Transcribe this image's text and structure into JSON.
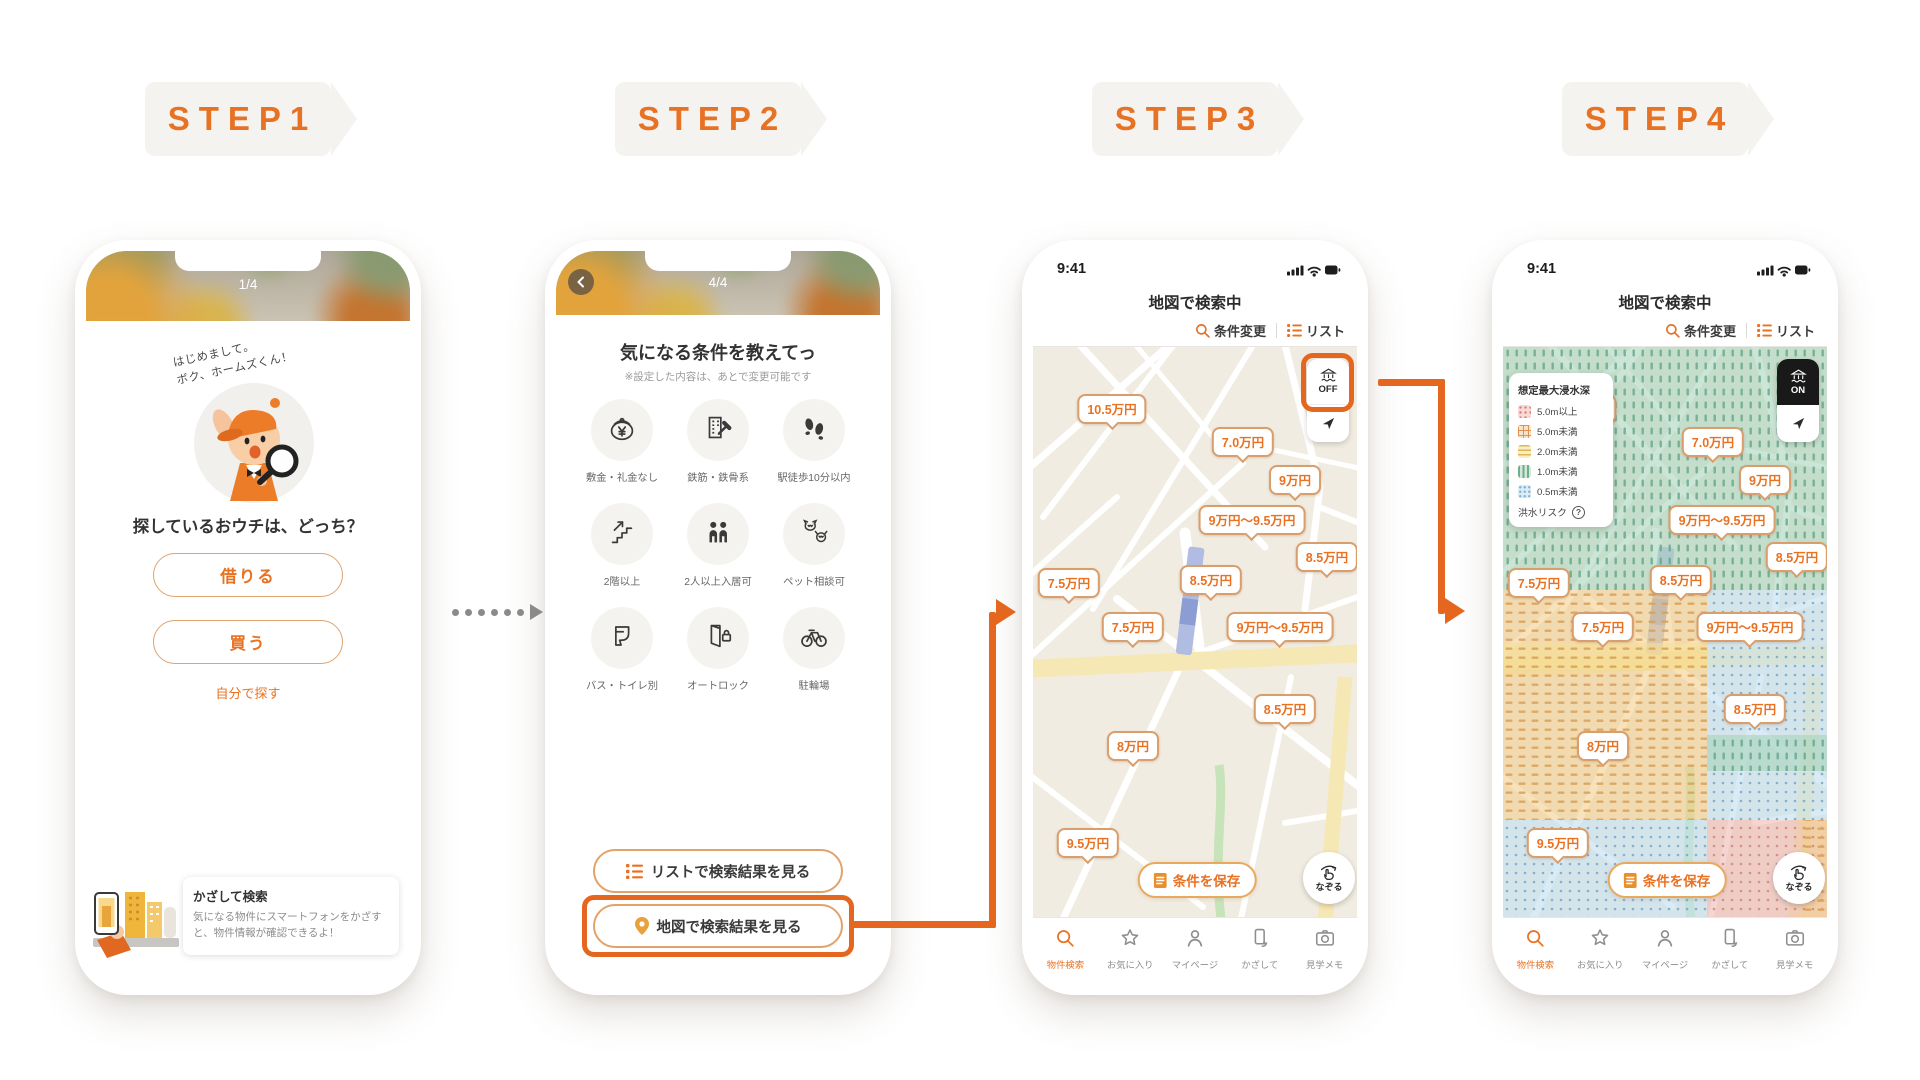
{
  "steps": [
    "STEP1",
    "STEP2",
    "STEP3",
    "STEP4"
  ],
  "colors": {
    "accent": "#E87122",
    "arrow": "#E5671F",
    "pin_border": "#D99E6B",
    "badge_bg": "#F5F3F0",
    "map_bg": "#F1ECE1"
  },
  "phone1": {
    "pager": "1/4",
    "speech_line1": "はじめまして。",
    "speech_line2": "ボク、ホームズくん！",
    "question": "探しているおウチは、どっち？",
    "rent_label": "借りる",
    "buy_label": "買う",
    "self_label": "自分で探す",
    "banner_title": "かざして検索",
    "banner_desc": "気になる物件にスマートフォンをかざすと、物件情報が確認できるよ！"
  },
  "phone2": {
    "pager": "4/4",
    "title": "気になる条件を教えてっ",
    "note": "※設定した内容は、あとで変更可能です",
    "conditions": [
      {
        "label": "敷金・礼金なし",
        "icon": "purse"
      },
      {
        "label": "鉄筋・鉄骨系",
        "icon": "building"
      },
      {
        "label": "駅徒歩10分以内",
        "icon": "footsteps"
      },
      {
        "label": "2階以上",
        "icon": "stairs"
      },
      {
        "label": "2人以上入居可",
        "icon": "people"
      },
      {
        "label": "ペット相談可",
        "icon": "pets"
      },
      {
        "label": "バス・トイレ別",
        "icon": "toilet"
      },
      {
        "label": "オートロック",
        "icon": "autolock"
      },
      {
        "label": "駐輪場",
        "icon": "bicycle"
      }
    ],
    "list_button_label": "リストで検索結果を見る",
    "map_button_label": "地図で検索結果を見る"
  },
  "map": {
    "status_time": "9:41",
    "title": "地図で検索中",
    "change_conditions_label": "条件変更",
    "list_label": "リスト",
    "toggle_off_label": "OFF",
    "toggle_on_label": "ON",
    "save_button_label": "条件を保存",
    "trace_button_label": "なぞる",
    "pins": [
      {
        "label": "10.5万円",
        "x": 79,
        "y": 62
      },
      {
        "label": "7.0万円",
        "x": 210,
        "y": 95
      },
      {
        "label": "9万円",
        "x": 262,
        "y": 133
      },
      {
        "label": "9万円〜9.5万円",
        "x": 219,
        "y": 173
      },
      {
        "label": "8.5万円",
        "x": 294,
        "y": 210
      },
      {
        "label": "7.5万円",
        "x": 36,
        "y": 236
      },
      {
        "label": "8.5万円",
        "x": 178,
        "y": 233
      },
      {
        "label": "7.5万円",
        "x": 100,
        "y": 280
      },
      {
        "label": "9万円〜9.5万円",
        "x": 247,
        "y": 280
      },
      {
        "label": "8.5万円",
        "x": 252,
        "y": 362
      },
      {
        "label": "8万円",
        "x": 100,
        "y": 399
      },
      {
        "label": "9.5万円",
        "x": 55,
        "y": 496
      }
    ],
    "tabs": [
      {
        "label": "物件検索",
        "icon": "search",
        "active": true
      },
      {
        "label": "お気に入り",
        "icon": "star",
        "active": false
      },
      {
        "label": "マイページ",
        "icon": "person",
        "active": false
      },
      {
        "label": "かざして",
        "icon": "phone",
        "active": false
      },
      {
        "label": "見学メモ",
        "icon": "camera",
        "active": false
      }
    ]
  },
  "legend": {
    "title": "想定最大浸水深",
    "items": [
      {
        "label": "5.0m以上",
        "key": "pink"
      },
      {
        "label": "5.0m未満",
        "key": "orange"
      },
      {
        "label": "2.0m未満",
        "key": "yellow"
      },
      {
        "label": "1.0m未満",
        "key": "green"
      },
      {
        "label": "0.5m未満",
        "key": "blue"
      }
    ],
    "footer": "洪水リスク"
  }
}
